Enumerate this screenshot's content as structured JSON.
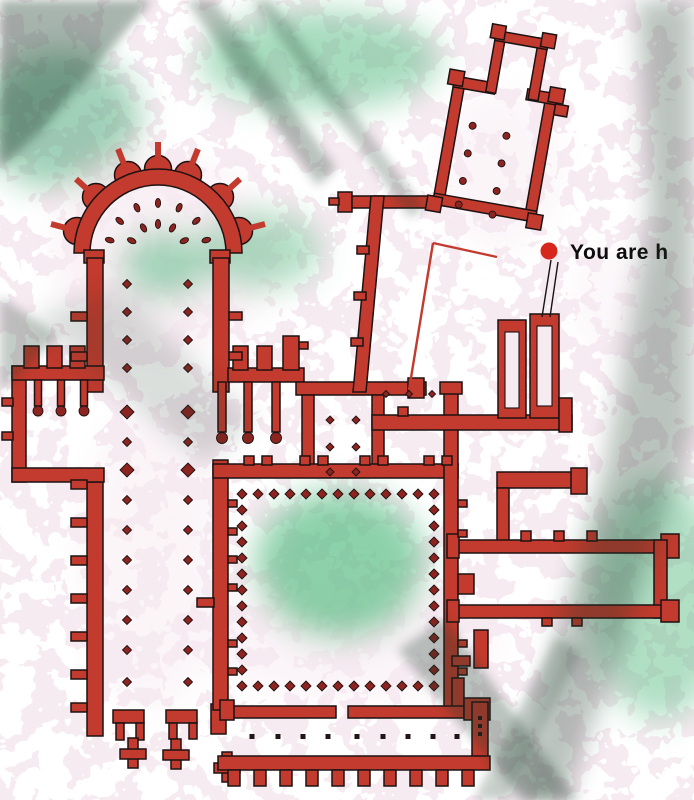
{
  "marker": {
    "label": "You are h",
    "dot_icon": "you-are-here-dot"
  },
  "colors": {
    "ground_pink": "#f7ebf2",
    "green_light": "#9dd9b6",
    "green_mid": "#4fb87d",
    "green_deep": "#2e9a62",
    "wall_red": "#c23b2e",
    "dot_red": "#8e2420",
    "marker_red": "#d7271c",
    "ink": "#1d1212",
    "shadow": "#1c3a2a",
    "text": "#0d0d0d"
  }
}
